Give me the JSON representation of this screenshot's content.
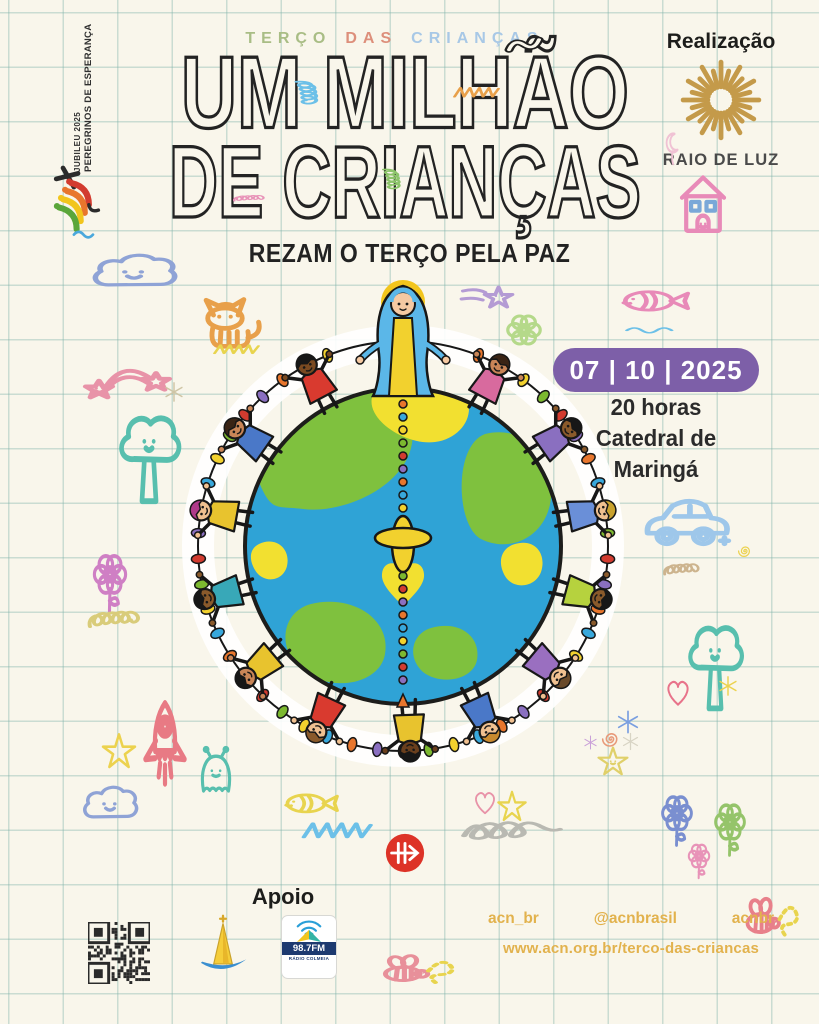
{
  "canvas": {
    "bg": "#f9f6eb",
    "grid_color": "rgba(126,178,168,0.38)"
  },
  "jubilee": {
    "line1": "JUBILEU 2025",
    "line2": "PEREGRINOS DE ESPERANÇA"
  },
  "header": {
    "kicker_words": [
      {
        "text": "TERÇO",
        "color": "#a9bd85"
      },
      {
        "text": "DAS",
        "color": "#dd8f7b"
      },
      {
        "text": "CRIANÇAS",
        "color": "#a8c8e6"
      }
    ],
    "title_line1": "UM MILHÃO",
    "title_line2": "DE CRIANÇAS",
    "subtitle": "REZAM O TERÇO PELA PAZ"
  },
  "realizacao": {
    "label": "Realização",
    "org": "RAIO DE LUZ",
    "sun_color": "#c49a4a",
    "rays": 24
  },
  "event": {
    "date": "07 | 10 | 2025",
    "time": "20 horas",
    "venue_line1": "Catedral de",
    "venue_line2": "Maringá",
    "badge_color": "#7d5fa8"
  },
  "apoio": {
    "label": "Apoio",
    "radio_station": "98.7FM",
    "radio_sub": "RÁDIO COLMEIA"
  },
  "social": {
    "handles": [
      "acn_br",
      "@acnbrasil",
      "acnbr"
    ],
    "url": "www.acn.org.br/terco-das-criancas",
    "color": "#e2b24d"
  },
  "illustration": {
    "ocean": "#2fa3d6",
    "land_green": "#7fc13e",
    "land_yellow": "#f2e030",
    "outline": "#1d1d1b",
    "mary": {
      "veil": "#5bb7e8",
      "robe": "#f2d12e",
      "halo": "#f2c51d",
      "skin": "#f5c9a2"
    },
    "bead_colors": [
      "#e8762d",
      "#38a8dc",
      "#f2d12e",
      "#7cb82f",
      "#d23b2f",
      "#8a6fc0"
    ],
    "children": [
      {
        "angle": -28,
        "shirt": "#d93a2f",
        "skin": "#7a4a21",
        "hair": "#171717"
      },
      {
        "angle": -55,
        "shirt": "#4a78c8",
        "skin": "#c98557",
        "hair": "#3a2415"
      },
      {
        "angle": -80,
        "shirt": "#e8c32e",
        "skin": "#f0c090",
        "hair": "#b03a8a"
      },
      {
        "angle": -105,
        "shirt": "#38a8b8",
        "skin": "#8a5a2b",
        "hair": "#171717"
      },
      {
        "angle": -130,
        "shirt": "#e8c32e",
        "skin": "#c98557",
        "hair": "#171717"
      },
      {
        "angle": -155,
        "shirt": "#d93a2f",
        "skin": "#f0c090",
        "hair": "#8a5a2b"
      },
      {
        "angle": 178,
        "shirt": "#e8c32e",
        "skin": "#6a3f1d",
        "hair": "#171717"
      },
      {
        "angle": 155,
        "shirt": "#4a78c8",
        "skin": "#f0c090",
        "hair": "#c98a2e"
      },
      {
        "angle": 130,
        "shirt": "#9a6fc0",
        "skin": "#f0c090",
        "hair": "#6a4a2a"
      },
      {
        "angle": 105,
        "shirt": "#b6d23e",
        "skin": "#8a5a2b",
        "hair": "#171717"
      },
      {
        "angle": 80,
        "shirt": "#6a8fd8",
        "skin": "#f0c090",
        "hair": "#c9a22e"
      },
      {
        "angle": 55,
        "shirt": "#8a6fc0",
        "skin": "#8a5a2b",
        "hair": "#171717"
      },
      {
        "angle": 28,
        "shirt": "#d86a9e",
        "skin": "#c98557",
        "hair": "#3a2415"
      }
    ]
  },
  "doodles": [
    {
      "type": "cloud",
      "x": 88,
      "y": 246,
      "w": 92,
      "h": 54,
      "color": "#8fa3d6",
      "face": true
    },
    {
      "type": "cat",
      "x": 193,
      "y": 280,
      "w": 82,
      "h": 78,
      "color": "#e8a04a"
    },
    {
      "type": "scribble",
      "x": 212,
      "y": 338,
      "w": 50,
      "h": 22,
      "color": "#e8d44e"
    },
    {
      "type": "shootstar",
      "x": 455,
      "y": 276,
      "w": 66,
      "h": 50,
      "color": "#b49bd4"
    },
    {
      "type": "flower",
      "x": 497,
      "y": 310,
      "w": 54,
      "h": 50,
      "color": "#b5d98a",
      "face": true
    },
    {
      "type": "rainbow",
      "x": 80,
      "y": 350,
      "w": 95,
      "h": 64,
      "color": "#e893a8"
    },
    {
      "type": "asterisk",
      "x": 162,
      "y": 380,
      "w": 24,
      "h": 24,
      "color": "#cfc5a5"
    },
    {
      "type": "tree",
      "x": 110,
      "y": 410,
      "w": 78,
      "h": 98,
      "color": "#58bfae",
      "face": true
    },
    {
      "type": "flower",
      "x": 84,
      "y": 548,
      "w": 52,
      "h": 66,
      "color": "#cf7fc4",
      "stem": true
    },
    {
      "type": "coil",
      "x": 86,
      "y": 592,
      "w": 66,
      "h": 48,
      "color": "#d9cc7a"
    },
    {
      "type": "star",
      "x": 98,
      "y": 730,
      "w": 42,
      "h": 44,
      "color": "#ecd24e"
    },
    {
      "type": "rocket",
      "x": 130,
      "y": 698,
      "w": 70,
      "h": 102,
      "color": "#e87a84"
    },
    {
      "type": "cloud",
      "x": 80,
      "y": 778,
      "w": 60,
      "h": 54,
      "color": "#8fa3d6",
      "face": true
    },
    {
      "type": "ghost",
      "x": 190,
      "y": 745,
      "w": 52,
      "h": 56,
      "color": "#58bfae",
      "face": true
    },
    {
      "type": "fish",
      "x": 280,
      "y": 780,
      "w": 62,
      "h": 45,
      "color": "#e8d44e"
    },
    {
      "type": "scribble",
      "x": 300,
      "y": 812,
      "w": 76,
      "h": 36,
      "color": "#6cc0e8"
    },
    {
      "type": "heart",
      "x": 470,
      "y": 786,
      "w": 30,
      "h": 32,
      "color": "#e893a8"
    },
    {
      "type": "star",
      "x": 494,
      "y": 788,
      "w": 36,
      "h": 38,
      "color": "#e8d44e"
    },
    {
      "type": "squiggleloop",
      "x": 460,
      "y": 810,
      "w": 104,
      "h": 46,
      "color": "#b9b9b2"
    },
    {
      "type": "fish",
      "x": 616,
      "y": 276,
      "w": 78,
      "h": 48,
      "color": "#e88ab8"
    },
    {
      "type": "wave",
      "x": 622,
      "y": 316,
      "w": 62,
      "h": 24,
      "color": "#6cc0e8"
    },
    {
      "type": "car",
      "x": 640,
      "y": 483,
      "w": 96,
      "h": 76,
      "color": "#9ec7ea"
    },
    {
      "type": "coil",
      "x": 662,
      "y": 550,
      "w": 46,
      "h": 34,
      "color": "#cdb48e"
    },
    {
      "type": "spiral",
      "x": 735,
      "y": 541,
      "w": 20,
      "h": 20,
      "color": "#ecd24e"
    },
    {
      "type": "tree",
      "x": 680,
      "y": 620,
      "w": 70,
      "h": 95,
      "color": "#58bfae",
      "face": true
    },
    {
      "type": "heart",
      "x": 662,
      "y": 674,
      "w": 32,
      "h": 36,
      "color": "#e8738a"
    },
    {
      "type": "asterisk",
      "x": 716,
      "y": 674,
      "w": 24,
      "h": 24,
      "color": "#ecd24e"
    },
    {
      "type": "asterisk",
      "x": 614,
      "y": 708,
      "w": 28,
      "h": 28,
      "color": "#7a9fe0"
    },
    {
      "type": "spiral",
      "x": 598,
      "y": 726,
      "w": 26,
      "h": 26,
      "color": "#e89a7a"
    },
    {
      "type": "asterisk",
      "x": 582,
      "y": 734,
      "w": 17,
      "h": 17,
      "color": "#c9a0d8"
    },
    {
      "type": "asterisk",
      "x": 620,
      "y": 731,
      "w": 21,
      "h": 21,
      "color": "#d8d4c4"
    },
    {
      "type": "star",
      "x": 594,
      "y": 744,
      "w": 38,
      "h": 36,
      "color": "#e0d06a",
      "face": true
    },
    {
      "type": "flower",
      "x": 653,
      "y": 790,
      "w": 48,
      "h": 58,
      "color": "#7a8fd0",
      "face": true,
      "stem": true
    },
    {
      "type": "flower",
      "x": 706,
      "y": 798,
      "w": 48,
      "h": 60,
      "color": "#95c46a",
      "stem": true
    },
    {
      "type": "flower",
      "x": 682,
      "y": 840,
      "w": 34,
      "h": 40,
      "color": "#e893b8",
      "stem": true
    },
    {
      "type": "bee",
      "x": 736,
      "y": 886,
      "w": 64,
      "h": 64,
      "color": "#e8808a",
      "color2": "#e8d44e"
    },
    {
      "type": "bee",
      "x": 370,
      "y": 946,
      "w": 86,
      "h": 48,
      "color": "#e8909a",
      "color2": "#e8d44e"
    },
    {
      "type": "tube",
      "x": 503,
      "y": 30,
      "w": 50,
      "h": 32,
      "color": "#1f1f1f"
    },
    {
      "type": "scribble",
      "x": 452,
      "y": 80,
      "w": 50,
      "h": 24,
      "color": "#e8a04a"
    },
    {
      "type": "coil",
      "x": 296,
      "y": 62,
      "w": 30,
      "h": 66,
      "color": "#6cc0e8",
      "rot": 90
    },
    {
      "type": "coil",
      "x": 382,
      "y": 155,
      "w": 26,
      "h": 52,
      "color": "#8cc46a",
      "rot": 90
    },
    {
      "type": "coil",
      "x": 232,
      "y": 188,
      "w": 40,
      "h": 18,
      "color": "#e893b8"
    },
    {
      "type": "moon",
      "x": 656,
      "y": 128,
      "w": 30,
      "h": 42,
      "color": "#f0c2d4"
    },
    {
      "type": "house",
      "x": 668,
      "y": 166,
      "w": 70,
      "h": 72,
      "color": "#e88ab8",
      "color2": "#7aa8d8"
    }
  ]
}
